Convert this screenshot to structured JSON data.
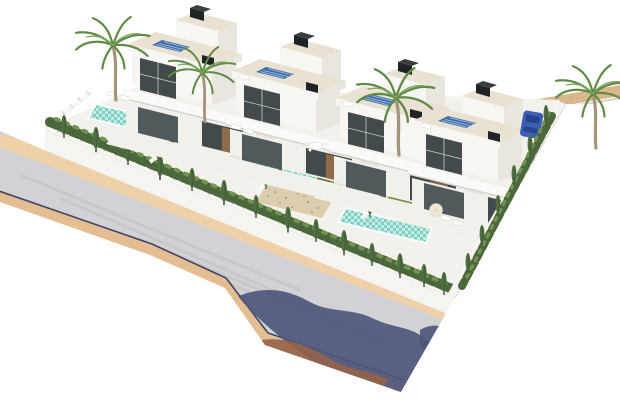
{
  "meta": {
    "title": "Aerial 3D architectural render of a row of four modern villas with private pools",
    "type": "architectural-visualization",
    "width": 620,
    "height": 406
  },
  "scene": {
    "villas": {
      "count": 4,
      "storeys": 2,
      "features": [
        "flat beige roof terrace",
        "rooftop solar panel",
        "black roof chimney boxes",
        "white balcony slab",
        "dark glazed doors",
        "wood accent panel",
        "front terrace deck",
        "roof sun lounger"
      ]
    },
    "gardens": [
      {
        "id": 1,
        "pool": "rectangular",
        "sun_loungers": 2
      },
      {
        "id": 2,
        "pool": "rectangular",
        "sun_loungers": 2,
        "lawn_strips": 1
      },
      {
        "id": 3,
        "pool": "rectangular",
        "lawn_strips": 1,
        "gravel_bed": true,
        "dining_set": true
      },
      {
        "id": 4,
        "pool": "L-shaped",
        "lawn_strips": 1,
        "sun_loungers": 2,
        "parasol": true
      }
    ],
    "landscaping": {
      "palm_trees": 4,
      "cypress_trees": 23,
      "hedge_rows": [
        "front fence",
        "right boundary wall"
      ],
      "white_rail_fence": true
    },
    "street": {
      "road": "curved two-lane asphalt",
      "sidewalks": [
        "inner tan",
        "outer tan"
      ],
      "curb_line": "navy",
      "tree_shadows": [
        "navy foliage",
        "rust foliage",
        "maroon band at tip"
      ]
    },
    "extras": [
      "rear tan path behind villas",
      "white boundary walls",
      "small blue car parked behind villa 4"
    ]
  },
  "colors": {
    "background": "#ffffff",
    "villa_white": "#f7f6f2",
    "villa_shade": "#e8e6df",
    "roof_beige": "#e9e1d1",
    "glass_dark": "#434a4b",
    "glass_mid": "#505a5c",
    "wood_accent": "#8d6c4c",
    "chimney_black": "#202325",
    "chimney_cap": "#3a3e41",
    "solar_blue": "#3e6cab",
    "solar_stripe": "#9fb9da",
    "pool_water": "#7fd0c4",
    "pool_light": "#c2ece4",
    "lawn_green": "#7c8b46",
    "lawn_dark": "#5f6e2f",
    "hedge_green": "#4b683c",
    "hedge_light": "#73944f",
    "cypress_green": "#4f6e41",
    "cypress_dark": "#3c5733",
    "palm_green": "#5f8b44",
    "palm_light": "#7fa95e",
    "palm_trunk": "#a3947c",
    "terrace": "#f2f0ea",
    "ground": "#f3f1ec",
    "fence_white": "#f8f7f4",
    "fence_post": "#dbd9d1",
    "wall_face": "#f5f4f0",
    "wall_edge": "#d9d7d0",
    "road_grey": "#d2d1d5",
    "road_streak": "#c3c2c8",
    "sidewalk_tan": "#e4bd92",
    "sidewalk_light": "#eed0a9",
    "curb_navy": "#3d4664",
    "shadow_navy": "#4d577b",
    "shadow_rust": "#95624a",
    "shadow_maroon": "#6f4a3b",
    "car_blue": "#3a5fb5",
    "car_dark": "#27448c",
    "path_tan": "#d9b78d",
    "furniture_white": "#ffffff",
    "furniture_edge": "#d9d6cf",
    "parasol_cream": "#efe6d3",
    "gravel": "#dbcdae",
    "gravel_dot": "#ae9b7e"
  }
}
